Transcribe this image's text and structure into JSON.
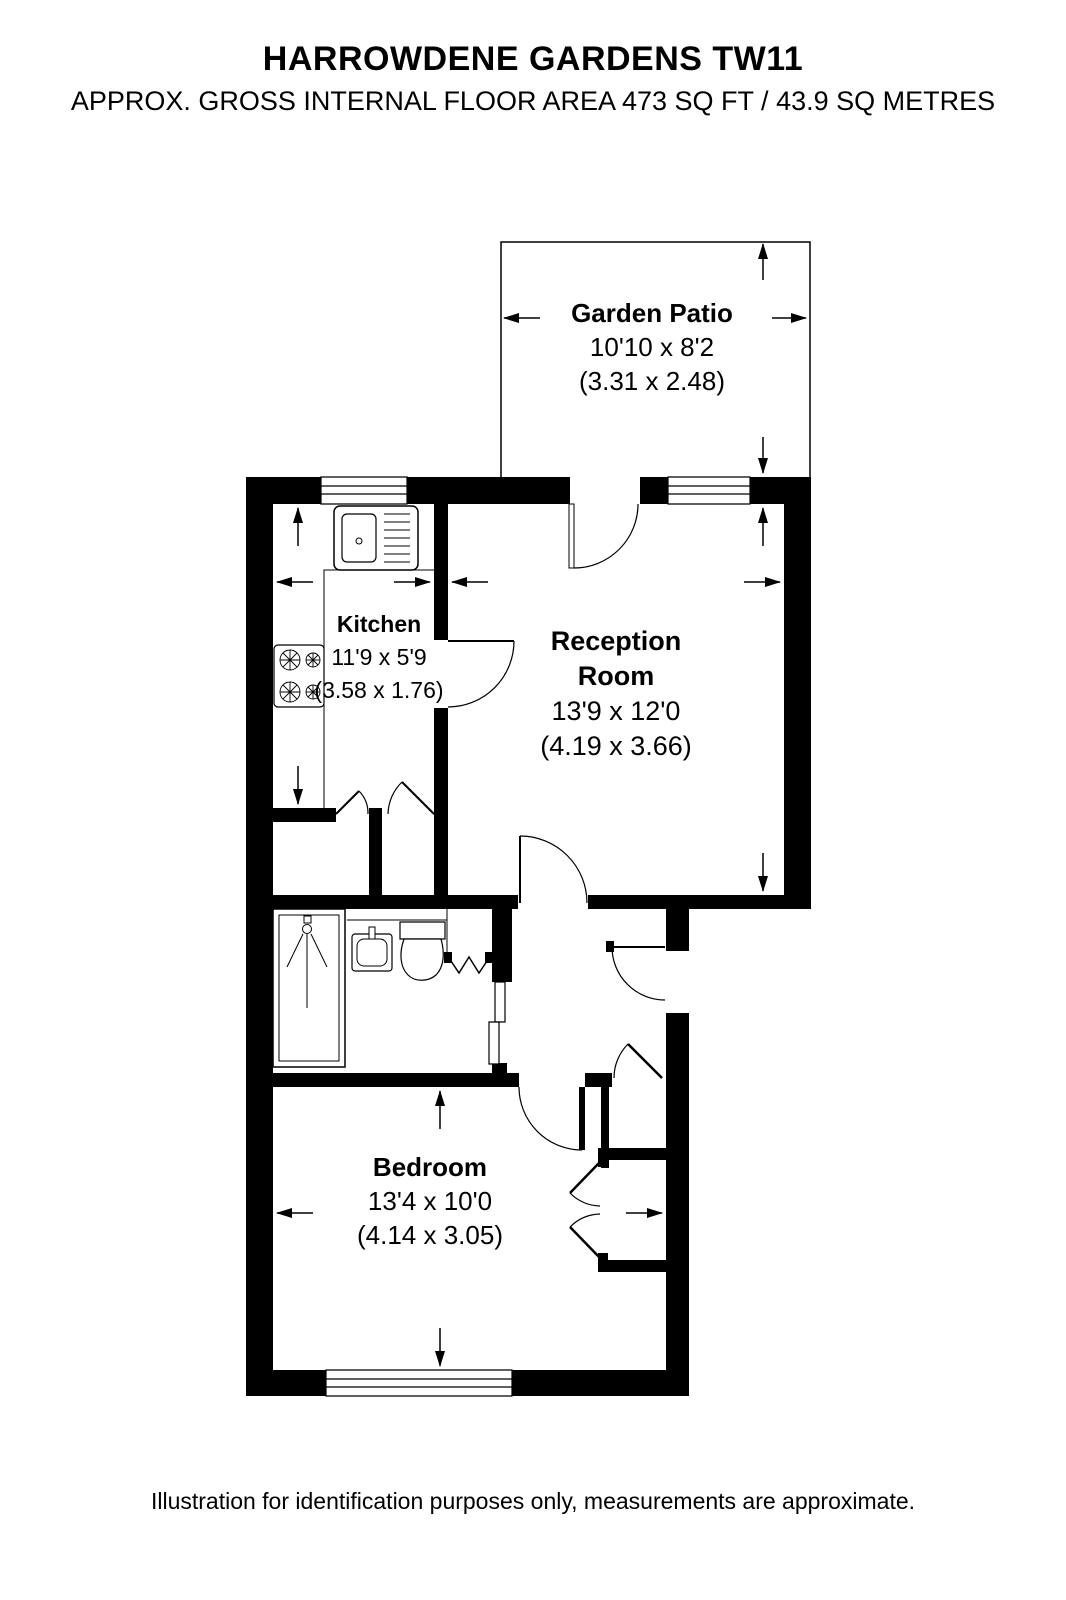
{
  "page": {
    "title": "HARROWDENE GARDENS TW11",
    "subtitle": "APPROX. GROSS INTERNAL FLOOR AREA 473 SQ FT / 43.9 SQ METRES",
    "disclaimer": "Illustration for identification purposes only, measurements are approximate."
  },
  "rooms": [
    {
      "name": "Garden Patio",
      "size_ft": "10'10 x 8'2",
      "size_m": "(3.31 x 2.48)"
    },
    {
      "name": "Kitchen",
      "size_ft": "11'9 x 5'9",
      "size_m": "(3.58 x 1.76)"
    },
    {
      "name": "Reception Room",
      "size_ft": "13'9 x 12'0",
      "size_m": "(4.19 x 3.66)"
    },
    {
      "name": "Bedroom",
      "size_ft": "13'4 x 10'0",
      "size_m": "(4.14 x 3.05)"
    }
  ],
  "icons": [
    "kitchen-sink-icon",
    "hob-icon",
    "shower-icon",
    "wash-basin-icon",
    "toilet-icon",
    "dimension-arrow-icon"
  ],
  "colors": {
    "walls": "#000000",
    "background": "#ffffff"
  }
}
